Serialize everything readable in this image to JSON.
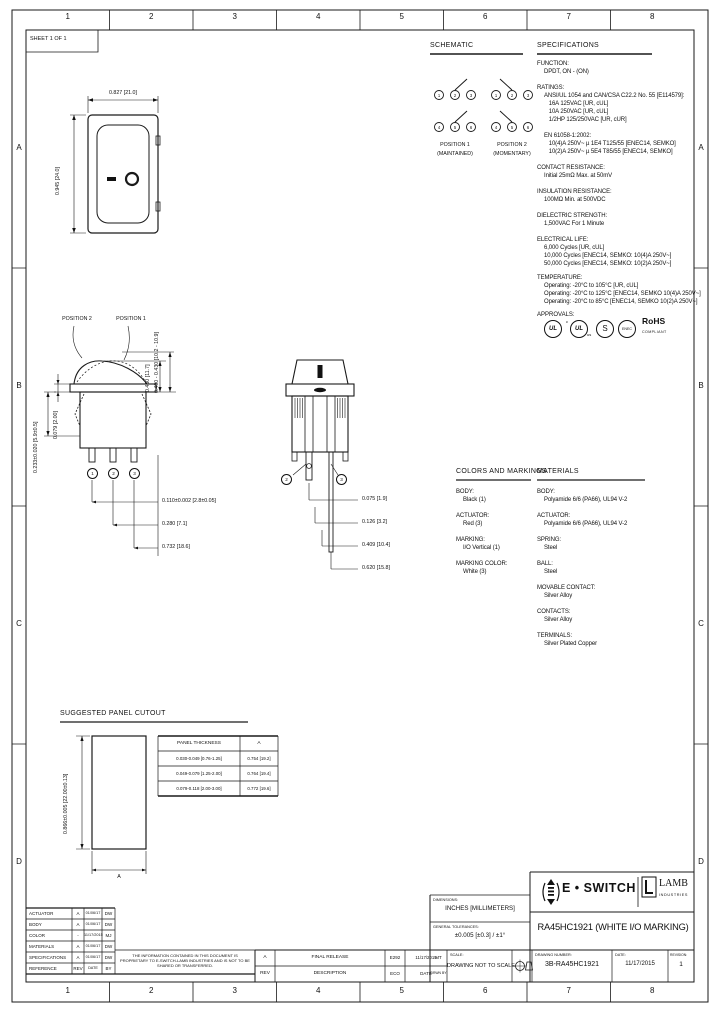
{
  "sheet": {
    "label": "SHEET 1 OF 1",
    "columns": [
      "1",
      "2",
      "3",
      "4",
      "5",
      "6",
      "7",
      "8"
    ],
    "rows": [
      "A",
      "B",
      "C",
      "D"
    ]
  },
  "front_view": {
    "width_dim": "0.827 [21.0]",
    "height_dim": "0.945 [24.0]"
  },
  "schematic": {
    "title": "SCHEMATIC",
    "pos1": {
      "terminals_top": [
        "1",
        "2",
        "3"
      ],
      "terminals_bottom": [
        "4",
        "5",
        "6"
      ],
      "label": "POSITION 1",
      "sub": "(MAINTAINED)"
    },
    "pos2": {
      "terminals_top": [
        "1",
        "2",
        "3"
      ],
      "terminals_bottom": [
        "4",
        "5",
        "6"
      ],
      "label": "POSITION 2",
      "sub": "(MOMENTARY)"
    }
  },
  "specs": {
    "title": "SPECIFICATIONS",
    "function": {
      "h": "FUNCTION:",
      "b": "DPDT, ON - (ON)"
    },
    "ratings": {
      "h": "RATINGS:",
      "b": "ANSI/UL 1054 and CAN/CSA C22.2 No. 55 [E114579]:\n   16A 125VAC [UR, cUL]\n   10A 250VAC [UR, cUL]\n   1/2HP 125/250VAC [UR, cUR]\n\nEN 61058-1:2002:\n   10(4)A 250V~ µ 1E4 T125/55 [ENEC14, SEMKO]\n   10(2)A 250V~ µ 5E4 T85/55 [ENEC14, SEMKO]"
    },
    "contact": {
      "h": "CONTACT RESISTANCE:",
      "b": "Initial 25mΩ Max. at 50mV"
    },
    "insulation": {
      "h": "INSULATION RESISTANCE:",
      "b": "100MΩ Min. at 500VDC"
    },
    "dielectric": {
      "h": "DIELECTRIC STRENGTH:",
      "b": "1,500VAC For 1 Minute"
    },
    "life": {
      "h": "ELECTRICAL LIFE:",
      "b": "6,000 Cycles [UR, cUL]\n10,000 Cycles [ENEC14, SEMKO: 10(4)A 250V~]\n50,000 Cycles [ENEC14, SEMKO: 10(2)A 250V~]"
    },
    "temperature": {
      "h": "TEMPERATURE:",
      "b": "Operating: -20°C to 105°C [UR, cUL]\nOperating: -20°C to 125°C [ENEC14, SEMKO 10(4)A 250V~]\nOperating: -20°C to 85°C [ENEC14, SEMKO 10(2)A 250V~]"
    },
    "approvals": {
      "h": "APPROVALS:",
      "ul": "UL",
      "cul_c": "c",
      "cul": "UL",
      "cul_us": "us",
      "semko": "S",
      "enec": "ENEC",
      "rohs": "RoHS",
      "rohs_sub": "COMPLIANT"
    }
  },
  "side_view": {
    "pos2_label": "POSITION 2",
    "pos1_label": "POSITION 1",
    "dim_actuator_height": "0.460 [11.7]",
    "dim_actuator_travel": "0.400 - 0.430 [10.2 - 10.9]",
    "dim_panel_thk": "0.079 [2.00]",
    "dim_clip_range": "0.233±0.020 [5.9±0.5]",
    "dim_terminal_w": "0.110±0.002 [2.8±0.05]",
    "dim_spacing1": "0.280 [7.1]",
    "dim_spacing2": "0.732 [18.6]",
    "terminals": [
      "1",
      "2",
      "3"
    ]
  },
  "end_view": {
    "dims": [
      "0.075 [1.9]",
      "0.126 [3.2]",
      "0.409 [10.4]",
      "0.620 [15.8]"
    ],
    "terminals": [
      "2",
      "3"
    ]
  },
  "colors": {
    "title": "COLORS AND MARKINGS",
    "items": [
      {
        "h": "BODY:",
        "b": "Black (1)"
      },
      {
        "h": "ACTUATOR:",
        "b": "Red (3)"
      },
      {
        "h": "MARKING:",
        "b": "I/O Vertical (1)"
      },
      {
        "h": "MARKING COLOR:",
        "b": "White (3)"
      }
    ]
  },
  "materials": {
    "title": "MATERIALS",
    "items": [
      {
        "h": "BODY:",
        "b": "Polyamide 6/6 (PA66), UL94 V-2"
      },
      {
        "h": "ACTUATOR:",
        "b": "Polyamide 6/6 (PA66), UL94 V-2"
      },
      {
        "h": "SPRING:",
        "b": "Steel"
      },
      {
        "h": "BALL:",
        "b": "Steel"
      },
      {
        "h": "MOVABLE CONTACT:",
        "b": "Silver Alloy"
      },
      {
        "h": "CONTACTS:",
        "b": "Silver Alloy"
      },
      {
        "h": "TERMINALS:",
        "b": "Silver Plated Copper"
      }
    ]
  },
  "cutout": {
    "title": "SUGGESTED PANEL CUTOUT",
    "height_dim": "0.866±0.005 [22.00±0.13]",
    "width_label": "A",
    "table": {
      "headers": [
        "PANEL THICKNESS",
        "A"
      ],
      "rows": [
        [
          "0.030-0.049 [0.76-1.25]",
          "0.754 [19.2]"
        ],
        [
          "0.049-0.079 [1.25-2.00]",
          "0.764 [19.4]"
        ],
        [
          "0.079-0.118 [2.00-3.00]",
          "0.772 [19.6]"
        ]
      ]
    }
  },
  "revisions": {
    "rows": [
      [
        "ACTUATOR",
        "A",
        "01/06/17",
        "DW"
      ],
      [
        "BODY",
        "A",
        "01/06/17",
        "DW"
      ],
      [
        "COLOR",
        "-",
        "11/17/2015",
        "MJ"
      ],
      [
        "MATERIALS",
        "A",
        "01/06/17",
        "DW"
      ],
      [
        "SPECIFICATIONS",
        "A",
        "01/06/17",
        "DW"
      ],
      [
        "REFERENCE",
        "REV",
        "DATE",
        "BY"
      ]
    ]
  },
  "proprietary_note": "THE INFORMATION CONTAINED IN THIS DOCUMENT IS PROPRIETARY TO E-SWITCH-LAMB INDUSTRIES AND IS NOT TO BE SHARED OR TRANSFERRED.",
  "release": {
    "rev": "A",
    "rev_h": "REV",
    "description": "FINAL RELEASE",
    "description_h": "DESCRIPTION",
    "eco": "E292",
    "eco_h": "ECO",
    "date": "11/17/2015",
    "date_h": "DATE",
    "drawn": "MT",
    "drawn_h": "DRWN BY"
  },
  "titleblock": {
    "dimensions_h": "DIMENSIONS:",
    "dimensions": "INCHES [MILLIMETERS]",
    "tolerances_h": "GENERAL TOLERANCES:",
    "tolerances": "±0.005 [±0.3] / ±1°",
    "brand": "E • SWITCH",
    "lamb": "LAMB",
    "lamb_sub": "INDUSTRIES",
    "title": "RA45HC1921 (WHITE I/O MARKING)",
    "scale_h": "SCALE:",
    "scale": "DRAWING NOT TO SCALE",
    "drawing_number_h": "DRAWING NUMBER:",
    "drawing_number": "3B-RA45HC1921",
    "date_h": "DATE:",
    "date": "11/17/2015",
    "revision_h": "REVISION:",
    "revision": "1"
  }
}
